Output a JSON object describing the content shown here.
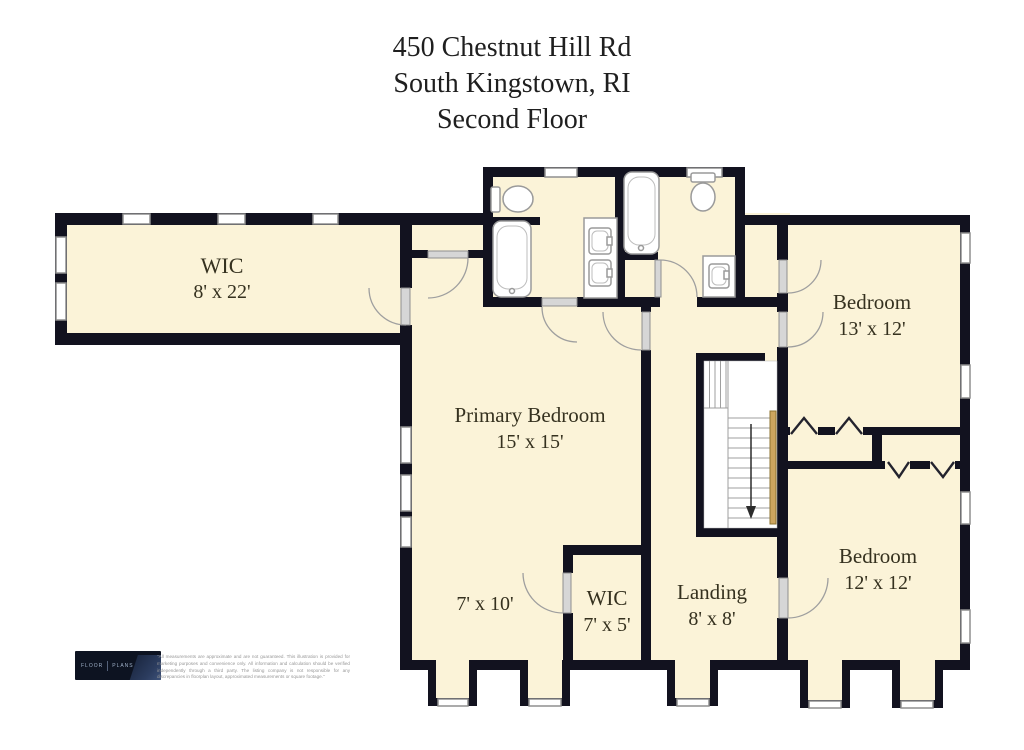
{
  "title": {
    "address": "450 Chestnut Hill Rd",
    "city": "South Kingstown, RI",
    "floor": "Second Floor"
  },
  "rooms": {
    "wic_large": {
      "name": "WIC",
      "dims": "8' x 22'"
    },
    "primary": {
      "name": "Primary Bedroom",
      "dims": "15' x 15'"
    },
    "alcove": {
      "dims": "7' x 10'"
    },
    "wic_small": {
      "name": "WIC",
      "dims": "7' x 5'"
    },
    "landing": {
      "name": "Landing",
      "dims": "8' x 8'"
    },
    "bedroom_top": {
      "name": "Bedroom",
      "dims": "13' x 12'"
    },
    "bedroom_bottom": {
      "name": "Bedroom",
      "dims": "12' x 12'"
    }
  },
  "fixtures": [
    "bathtub",
    "toilet",
    "sink-vanity",
    "staircase",
    "window",
    "door",
    "bifold-closet-door",
    "railing"
  ],
  "footer": {
    "logo_left": "FLOOR",
    "logo_right": "PLANS",
    "disclaimer": "\"All measurements are approximate and are not guaranteed. This illustration is provided for marketing purposes and convenience only. All information and calculation should be verified independently through a third party. The listing company is not responsible for any discrepancies in floorplan layout, approximated measurements or square footage.\""
  },
  "colors": {
    "floor": "#fbf3d8",
    "wall": "#12121f",
    "railing": "#cda55e",
    "label": "#35311f"
  }
}
